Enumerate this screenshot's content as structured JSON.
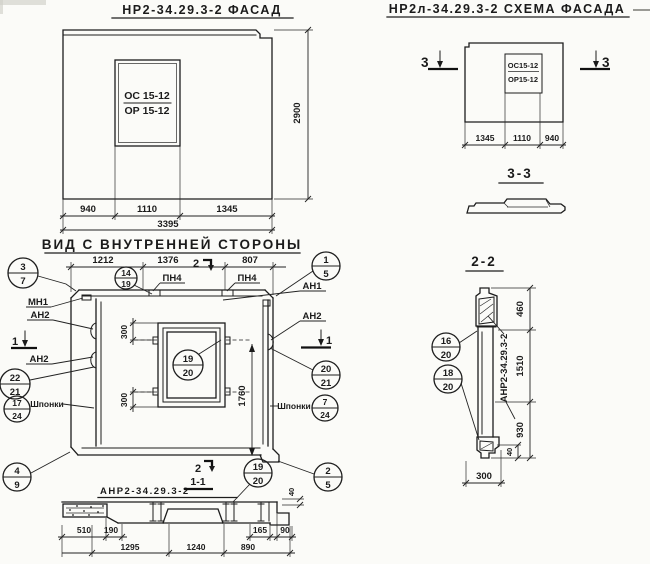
{
  "facade": {
    "title": "НР2-34.29.3-2  ФАСАД",
    "window_top": "ОС 15-12",
    "window_bottom": "ОР 15-12",
    "dim_left": "940",
    "dim_mid": "1110",
    "dim_right": "1345",
    "dim_total": "3395",
    "dim_height": "2900"
  },
  "schema": {
    "title": "НР2л-34.29.3-2  СХЕМА ФАСАДА",
    "window_top": "ОС15-12",
    "window_bottom": "ОР15-12",
    "dim_left": "1345",
    "dim_mid": "1110",
    "dim_right": "940",
    "mark": "3",
    "section_title": "3-3"
  },
  "inner": {
    "title": "ВИД С ВНУТРЕННЕЙ СТОРОНЫ",
    "dim_1": "1212",
    "dim_2": "1376",
    "dim_3": "807",
    "dim_300_top": "300",
    "dim_300_bottom": "300",
    "dim_1760": "1760",
    "mark_1": "1",
    "mark_2": "2",
    "labels": {
      "pn4": "ПН4",
      "mn1": "МН1",
      "an1": "АН1",
      "an2": "АН2",
      "shponki": "Шпонки"
    },
    "callouts": {
      "c3_7": {
        "top": "3",
        "bottom": "7"
      },
      "c14_19": {
        "top": "14",
        "bottom": "19"
      },
      "c1_5": {
        "top": "1",
        "bottom": "5"
      },
      "c22_21": {
        "top": "22",
        "bottom": "21"
      },
      "c17_24": {
        "top": "17",
        "bottom": "24"
      },
      "c4_9": {
        "top": "4",
        "bottom": "9"
      },
      "c20_21": {
        "top": "20",
        "bottom": "21"
      },
      "c7_24": {
        "top": "7",
        "bottom": "24"
      },
      "c19_20": {
        "top": "19",
        "bottom": "20"
      }
    }
  },
  "sec11": {
    "label": "АНР2-34.29.3-2",
    "title": "1-1",
    "mark": "2",
    "c19_20": {
      "top": "19",
      "bottom": "20"
    },
    "c2_5": {
      "top": "2",
      "bottom": "5"
    },
    "d510": "510",
    "d190": "190",
    "d165": "165",
    "d90": "90",
    "d1295": "1295",
    "d1240": "1240",
    "d890": "890",
    "d40": "40"
  },
  "sec22": {
    "title": "2-2",
    "label": "АНР2-34.29.3-2",
    "c16_20": {
      "top": "16",
      "bottom": "20"
    },
    "c18_20": {
      "top": "18",
      "bottom": "20"
    },
    "d460": "460",
    "d1510": "1510",
    "d930": "930",
    "d40": "40",
    "d300": "300"
  }
}
